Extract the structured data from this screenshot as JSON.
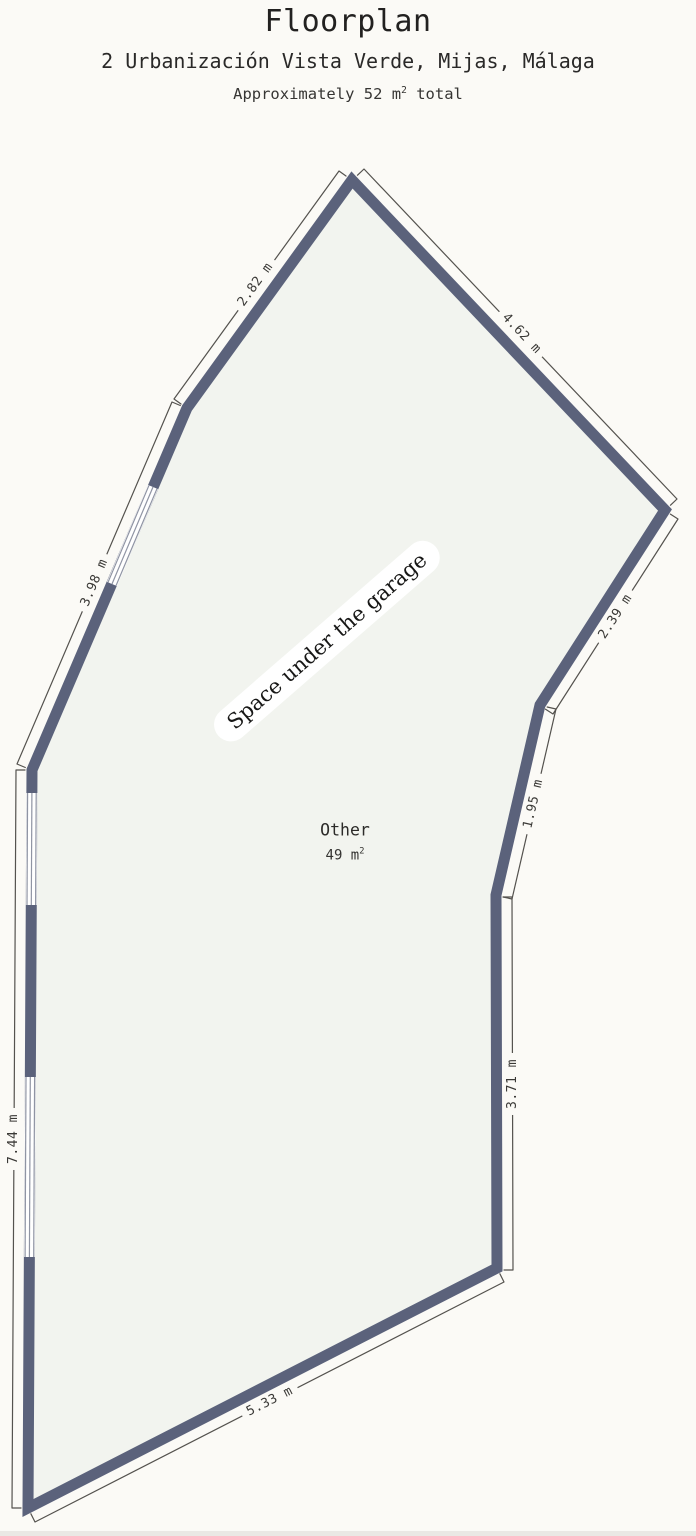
{
  "header": {
    "title": "Floorplan",
    "subtitle": "2 Urbanización Vista Verde, Mijas, Málaga",
    "area_note": {
      "prefix": "Approximately 52 m",
      "sup": "2",
      "suffix": " total"
    }
  },
  "floorplan": {
    "space_label": "Space under the garage",
    "room": {
      "name": "Other",
      "area_prefix": "49 m",
      "area_sup": "2"
    },
    "dimensions": [
      {
        "side": "upper-left-wall",
        "label": "2.82 m"
      },
      {
        "side": "upper-right-wall",
        "label": "4.62 m"
      },
      {
        "side": "right-upper-wall",
        "label": "2.39 m"
      },
      {
        "side": "right-mid-wall",
        "label": "1.95 m"
      },
      {
        "side": "right-lower-wall",
        "label": "3.71 m"
      },
      {
        "side": "bottom-wall",
        "label": "5.33 m"
      },
      {
        "side": "left-wall",
        "label": "7.44 m"
      },
      {
        "side": "left-upper-wall",
        "label": "3.98 m"
      }
    ],
    "colors": {
      "wall": "#5b627b",
      "interior": "#f2f4ef",
      "background": "#fbfaf6",
      "dimension_line": "#54524e",
      "window_frame": "#8f94a3",
      "window_fill": "#ffffff",
      "text": "#2e2d2b",
      "label_pill_background": "#ffffff"
    }
  }
}
